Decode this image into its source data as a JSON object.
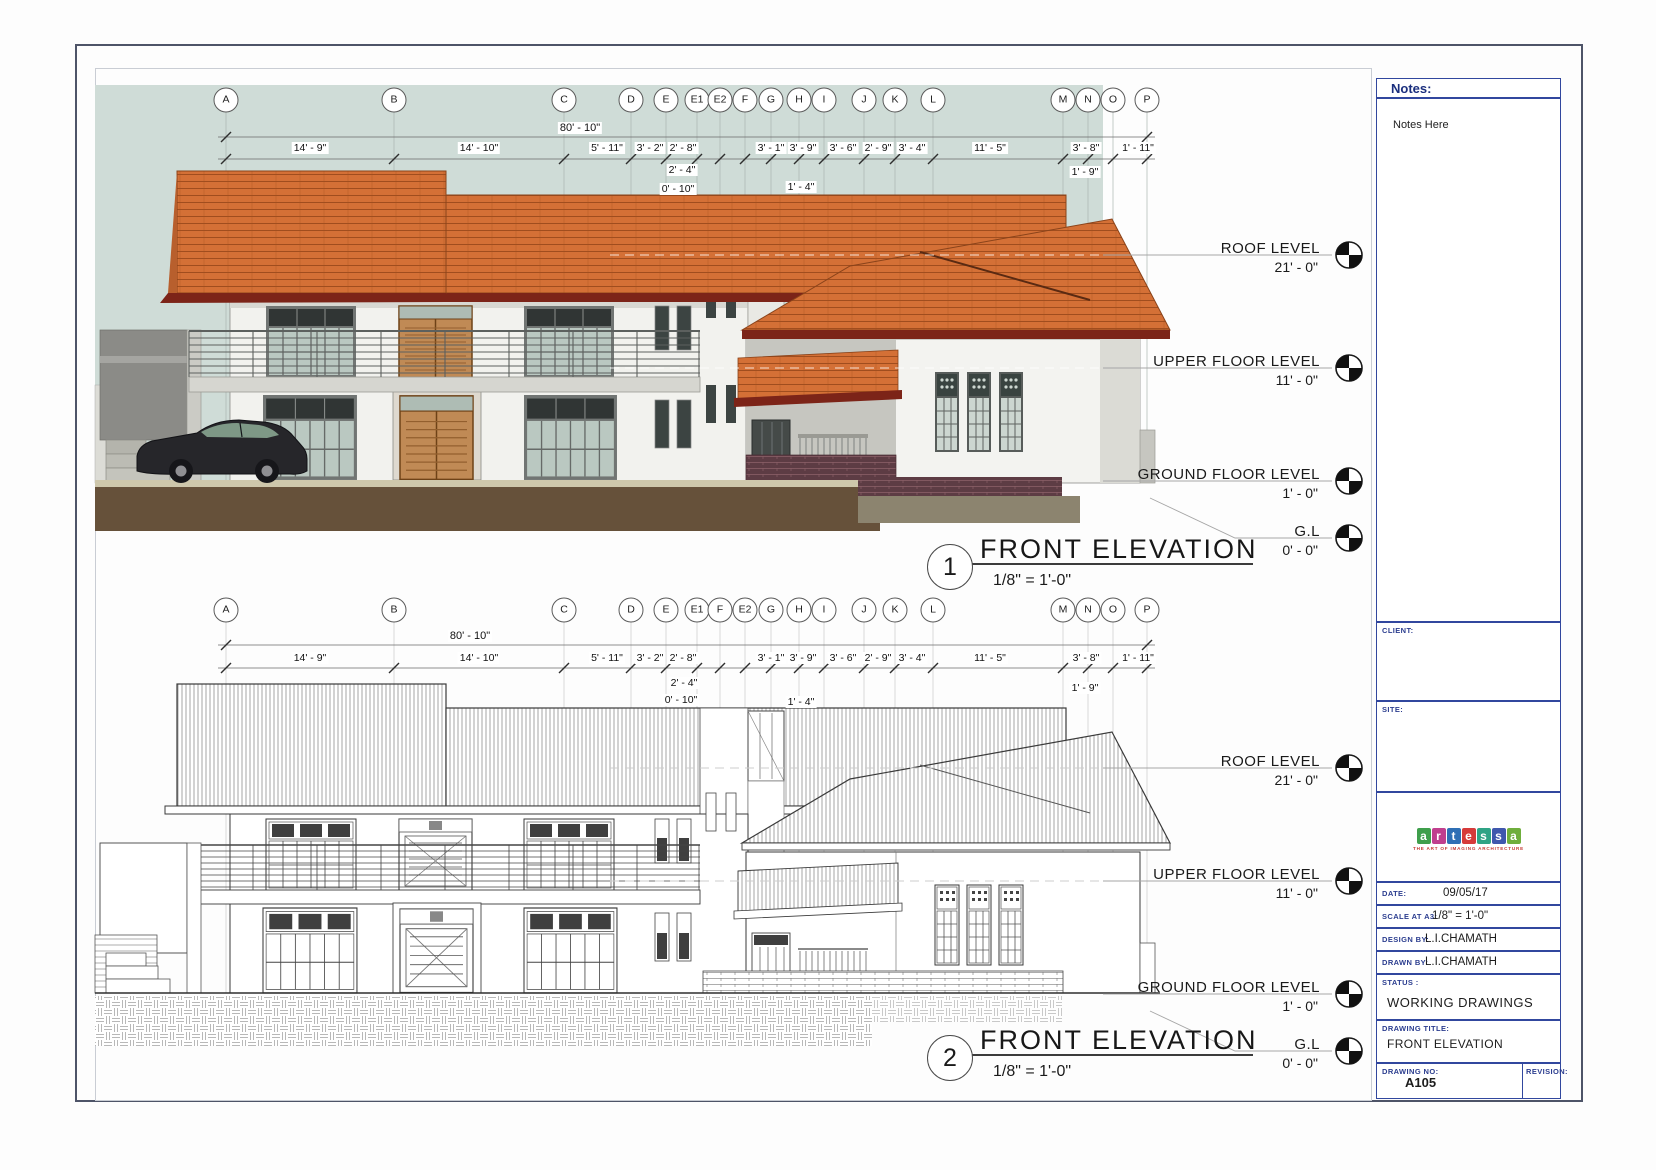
{
  "colors": {
    "sky": "#cfdcd7",
    "roof_orange": "#d47036",
    "roof_fascia": "#7c2418",
    "ground_brown": "#66513a",
    "title_navy": "#2b3d8f",
    "line_dark": "#3a3a3a"
  },
  "sheet": {
    "grid_x": [
      226,
      394,
      564,
      631,
      666,
      697,
      720,
      745,
      771,
      799,
      824,
      864,
      895,
      933,
      1063,
      1088,
      1113,
      1147
    ],
    "bubbles_top": [
      {
        "letter": "A",
        "x": 226
      },
      {
        "letter": "B",
        "x": 394
      },
      {
        "letter": "C",
        "x": 564
      },
      {
        "letter": "D",
        "x": 631
      },
      {
        "letter": "E",
        "x": 666
      },
      {
        "letter": "E1",
        "x": 697
      },
      {
        "letter": "E2",
        "x": 720
      },
      {
        "letter": "F",
        "x": 745
      },
      {
        "letter": "G",
        "x": 771
      },
      {
        "letter": "H",
        "x": 799
      },
      {
        "letter": "I",
        "x": 824
      },
      {
        "letter": "J",
        "x": 864
      },
      {
        "letter": "K",
        "x": 895
      },
      {
        "letter": "L",
        "x": 933
      },
      {
        "letter": "M",
        "x": 1063
      },
      {
        "letter": "N",
        "x": 1088
      },
      {
        "letter": "O",
        "x": 1113
      },
      {
        "letter": "P",
        "x": 1147
      }
    ],
    "bubbles_bottom": [
      {
        "letter": "A",
        "x": 226
      },
      {
        "letter": "B",
        "x": 394
      },
      {
        "letter": "C",
        "x": 564
      },
      {
        "letter": "D",
        "x": 631
      },
      {
        "letter": "E",
        "x": 666
      },
      {
        "letter": "E1",
        "x": 697
      },
      {
        "letter": "F",
        "x": 720
      },
      {
        "letter": "E2",
        "x": 745
      },
      {
        "letter": "G",
        "x": 771
      },
      {
        "letter": "H",
        "x": 799
      },
      {
        "letter": "I",
        "x": 824
      },
      {
        "letter": "J",
        "x": 864
      },
      {
        "letter": "K",
        "x": 895
      },
      {
        "letter": "L",
        "x": 933
      },
      {
        "letter": "M",
        "x": 1063
      },
      {
        "letter": "N",
        "x": 1088
      },
      {
        "letter": "O",
        "x": 1113
      },
      {
        "letter": "P",
        "x": 1147
      }
    ],
    "dims_overall": "80' - 10\"",
    "dim_labels": [
      {
        "t": "14' - 9\"",
        "x": 310
      },
      {
        "t": "14' - 10\"",
        "x": 479
      },
      {
        "t": "5' - 11\"",
        "x": 607
      },
      {
        "t": "3' - 2\"",
        "x": 650
      },
      {
        "t": "2' - 8\"",
        "x": 683
      },
      {
        "t": "3' - 1\"",
        "x": 771
      },
      {
        "t": "3' - 9\"",
        "x": 803
      },
      {
        "t": "3' - 6\"",
        "x": 843
      },
      {
        "t": "2' - 9\"",
        "x": 878
      },
      {
        "t": "3' - 4\"",
        "x": 912
      },
      {
        "t": "11' - 5\"",
        "x": 990
      },
      {
        "t": "3' - 8\"",
        "x": 1086
      },
      {
        "t": "1' - 11\"",
        "x": 1138
      }
    ],
    "subs_top": [
      {
        "t": "2' - 4\"",
        "x": 682,
        "y": 170
      },
      {
        "t": "0' - 10\"",
        "x": 678,
        "y": 189
      },
      {
        "t": "1' - 4\"",
        "x": 801,
        "y": 187
      },
      {
        "t": "1' - 9\"",
        "x": 1085,
        "y": 172
      }
    ],
    "subs_bottom": [
      {
        "t": "2' - 4\"",
        "x": 684,
        "y": 683
      },
      {
        "t": "0' - 10\"",
        "x": 681,
        "y": 700
      },
      {
        "t": "1' - 4\"",
        "x": 801,
        "y": 702
      },
      {
        "t": "1' - 9\"",
        "x": 1085,
        "y": 688
      }
    ],
    "levels": [
      {
        "name": "ROOF LEVEL",
        "value": "21' - 0\"",
        "y": 240
      },
      {
        "name": "UPPER FLOOR LEVEL",
        "value": "11' - 0\"",
        "y": 353
      },
      {
        "name": "GROUND FLOOR LEVEL",
        "value": "1' - 0\"",
        "y": 466
      },
      {
        "name": "G.L",
        "value": "0' - 0\"",
        "y": 523
      }
    ],
    "view1": {
      "number": "1",
      "title": "FRONT ELEVATION",
      "scale": "1/8\" = 1'-0\""
    },
    "view2": {
      "number": "2",
      "title": "FRONT ELEVATION",
      "scale": "1/8\" = 1'-0\""
    }
  },
  "titleblock": {
    "notes_label": "Notes:",
    "notes_body": "Notes Here",
    "client_label": "CLIENT:",
    "site_label": "SITE:",
    "logo": {
      "letters": [
        {
          "ch": "a",
          "bg": "#3f9f4c"
        },
        {
          "ch": "r",
          "bg": "#c03f8e"
        },
        {
          "ch": "t",
          "bg": "#2f6fb5"
        },
        {
          "ch": "e",
          "bg": "#d63a3a"
        },
        {
          "ch": "s",
          "bg": "#2fa385"
        },
        {
          "ch": "s",
          "bg": "#3f57ad"
        },
        {
          "ch": "a",
          "bg": "#6fae3c"
        }
      ],
      "tagline": "THE ART OF IMAGING ARCHITECTURE"
    },
    "fields": [
      {
        "label": "DATE:",
        "value": "09/05/17"
      },
      {
        "label": "SCALE AT A3:",
        "value": "1/8\" = 1'-0\""
      },
      {
        "label": "DESIGN BY:",
        "value": "L.I.CHAMATH"
      },
      {
        "label": "DRAWN BY:",
        "value": "L.I.CHAMATH"
      }
    ],
    "status_label": "STATUS :",
    "status_value": "WORKING DRAWINGS",
    "drawing_title_label": "DRAWING TITLE:",
    "drawing_title_value": "FRONT ELEVATION",
    "drawing_no_label": "DRAWING NO:",
    "drawing_no_value": "A105",
    "revision_label": "REVISION:"
  }
}
